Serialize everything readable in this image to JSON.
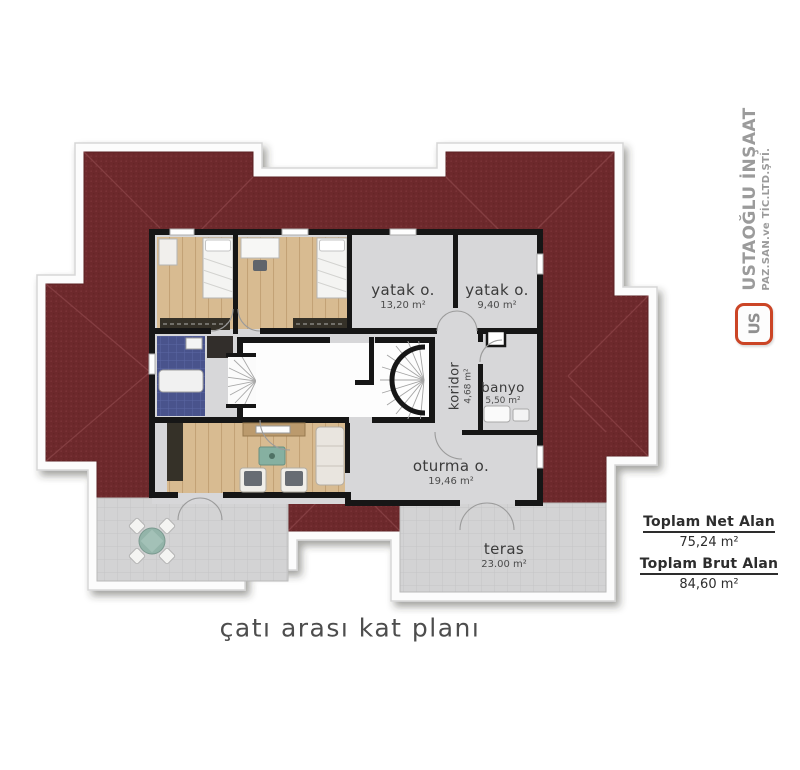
{
  "caption": "çatı arası kat planı",
  "logo": {
    "company": "USTAOĞLU İNŞAAT",
    "subtitle": "PAZ.SAN.ve TİC.LTD.ŞTİ.",
    "monogram": "US"
  },
  "rooms": {
    "yatak1": {
      "name": "yatak o.",
      "area": "13,20 m²"
    },
    "yatak2": {
      "name": "yatak o.",
      "area": "9,40 m²"
    },
    "koridor": {
      "name": "koridor",
      "area": "4,68 m²"
    },
    "banyo": {
      "name": "banyo",
      "area": "5,50 m²"
    },
    "oturma": {
      "name": "oturma o.",
      "area": "19,46 m²"
    },
    "teras": {
      "name": "teras",
      "area": "23.00 m²"
    }
  },
  "summary": {
    "net_label": "Toplam Net Alan",
    "net_value": "75,24 m²",
    "brut_label": "Toplam Brut Alan",
    "brut_value": "84,60 m²"
  },
  "colors": {
    "roof": "#6d292c",
    "roof_dot": "#7e363a",
    "floor": "#d7d7d9",
    "wood": "#d8bb91",
    "wall": "#161616",
    "terrace_tile": "#d3d3d4",
    "logo_accent": "#cb4526",
    "logo_gray": "#9b9b9b"
  }
}
